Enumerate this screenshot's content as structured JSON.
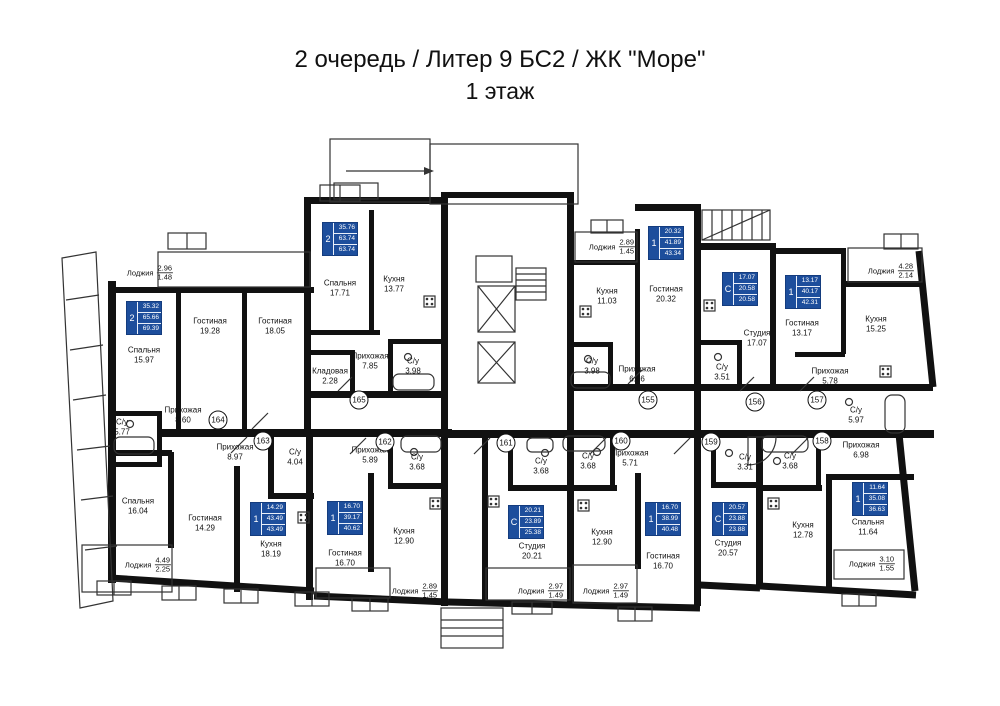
{
  "title": {
    "line1": "2 очередь / Литер 9 БС2 / ЖК \"Море\"",
    "line2": "1 этаж"
  },
  "colors": {
    "accent_blue": "#1d4e9c",
    "wall": "#111111",
    "background": "#ffffff"
  },
  "apartments": [
    {
      "num": "155",
      "type": "1",
      "living": "20.32",
      "area": "41.89",
      "total": "43.34"
    },
    {
      "num": "156",
      "type": "С",
      "living": "17.07",
      "area": "20.58",
      "total": "20.58"
    },
    {
      "num": "157",
      "type": "1",
      "living": "13.17",
      "area": "40.17",
      "total": "42.31"
    },
    {
      "num": "158",
      "type": "1",
      "living": "11.64",
      "area": "35.08",
      "total": "36.63"
    },
    {
      "num": "159",
      "type": "С",
      "living": "20.57",
      "area": "23.88",
      "total": "23.88"
    },
    {
      "num": "160",
      "type": "1",
      "living": "16.70",
      "area": "38.99",
      "total": "40.48"
    },
    {
      "num": "161",
      "type": "С",
      "living": "20.21",
      "area": "23.89",
      "total": "25.38"
    },
    {
      "num": "162",
      "type": "1",
      "living": "16.70",
      "area": "39.17",
      "total": "40.62"
    },
    {
      "num": "163",
      "type": "1",
      "living": "14.29",
      "area": "43.49",
      "total": "43.49"
    },
    {
      "num": "164",
      "type": "2",
      "living": "35.32",
      "area": "65.66",
      "total": "69.39"
    },
    {
      "num": "165",
      "type": "2",
      "living": "35.76",
      "area": "63.74",
      "total": "63.74"
    }
  ],
  "rooms": [
    {
      "label": "Спальня",
      "area": "15.97"
    },
    {
      "label": "Гостиная",
      "area": "19.28"
    },
    {
      "label": "Гостиная",
      "area": "18.05"
    },
    {
      "label": "Прихожая",
      "area": "8.60"
    },
    {
      "label": "С/у",
      "area": "5.77"
    },
    {
      "label": "Спальня",
      "area": "17.71"
    },
    {
      "label": "Кухня",
      "area": "13.77"
    },
    {
      "label": "Прихожая",
      "area": "7.85"
    },
    {
      "label": "С/у",
      "area": "3.98"
    },
    {
      "label": "Кладовая",
      "area": "2.28"
    },
    {
      "label": "Кухня",
      "area": "11.03"
    },
    {
      "label": "Гостиная",
      "area": "20.32"
    },
    {
      "label": "Прихожая",
      "area": "6.56"
    },
    {
      "label": "С/у",
      "area": "3.98"
    },
    {
      "label": "Студия",
      "area": "17.07"
    },
    {
      "label": "С/у",
      "area": "3.51"
    },
    {
      "label": "Гостиная",
      "area": "13.17"
    },
    {
      "label": "Кухня",
      "area": "15.25"
    },
    {
      "label": "Прихожая",
      "area": "5.78"
    },
    {
      "label": "С/у",
      "area": "5.97"
    },
    {
      "label": "Прихожая",
      "area": "6.98"
    },
    {
      "label": "С/у",
      "area": "3.68"
    },
    {
      "label": "Кухня",
      "area": "12.78"
    },
    {
      "label": "Спальня",
      "area": "11.64"
    },
    {
      "label": "Спальня",
      "area": "16.04"
    },
    {
      "label": "Гостиная",
      "area": "14.29"
    },
    {
      "label": "Прихожая",
      "area": "8.97"
    },
    {
      "label": "С/у",
      "area": "4.04"
    },
    {
      "label": "Кухня",
      "area": "18.19"
    },
    {
      "label": "Прихожая",
      "area": "5.89"
    },
    {
      "label": "С/у",
      "area": "3.68"
    },
    {
      "label": "Гостиная",
      "area": "16.70"
    },
    {
      "label": "Кухня",
      "area": "12.90"
    },
    {
      "label": "С/у",
      "area": "3.68"
    },
    {
      "label": "Студия",
      "area": "20.21"
    },
    {
      "label": "Прихожая",
      "area": "5.71"
    },
    {
      "label": "С/у",
      "area": "3.68"
    },
    {
      "label": "Кухня",
      "area": "12.90"
    },
    {
      "label": "Гостиная",
      "area": "16.70"
    },
    {
      "label": "С/у",
      "area": "3.31"
    },
    {
      "label": "Студия",
      "area": "20.57"
    }
  ],
  "loggias": [
    {
      "label": "Лоджия",
      "a": "2.96",
      "b": "1.48"
    },
    {
      "label": "Лоджия",
      "a": "2.89",
      "b": "1.45"
    },
    {
      "label": "Лоджия",
      "a": "4.28",
      "b": "2.14"
    },
    {
      "label": "Лоджия",
      "a": "4.49",
      "b": "2.25"
    },
    {
      "label": "Лоджия",
      "a": "2.89",
      "b": "1.45"
    },
    {
      "label": "Лоджия",
      "a": "2.97",
      "b": "1.49"
    },
    {
      "label": "Лоджия",
      "a": "2.97",
      "b": "1.49"
    },
    {
      "label": "Лоджия",
      "a": "3.10",
      "b": "1.55"
    }
  ]
}
